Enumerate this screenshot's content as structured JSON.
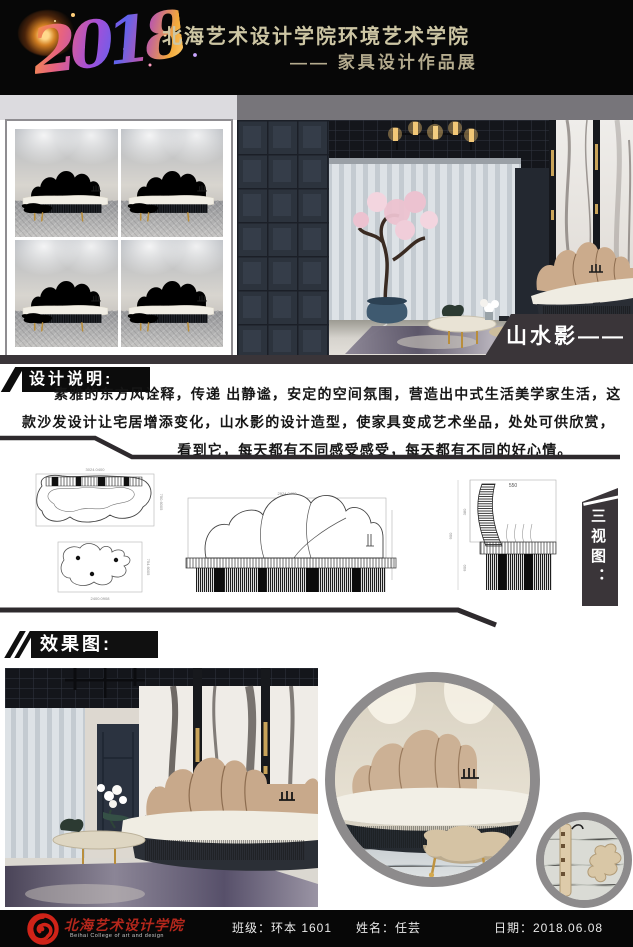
{
  "header": {
    "year": "2018",
    "school": "北海艺术设计学院环境艺术学院",
    "exhibition": "—— 家具设计作品展"
  },
  "top_section": {
    "project_label": "山水影——"
  },
  "design_notes": {
    "label": "设计说明:",
    "line1": "素雅的东方风诠释，传递 出静谧，安定的空间氛围，营造出中式生活美学家生活，这",
    "line2": "款沙发设计让宅居增添变化，山水影的设计造型，使家具变成艺术坐品，处处可供欣赏，",
    "line3": "看到它，每天都有不同感受感受，每天都有不同的好心情。"
  },
  "three_views": {
    "label": "三视图：",
    "dim_side_width": "550",
    "dim_side_back": "380",
    "dim_side_seat": "600",
    "dim_side_total": "900",
    "dim_front_width": "2924.0400",
    "dim_plan_width": "3024.0400",
    "dim_plan_depth": "750.6005",
    "dim_plan2_width": "2400.0908",
    "dim_plan2_depth": "754.6005"
  },
  "renders": {
    "label": "效果图:"
  },
  "footer": {
    "school_cn": "北海艺术设计学院",
    "school_en": "Beihai College of art and design",
    "class_field": "班级：环本 1601",
    "name_field": "姓名：任芸",
    "date_field": "日期：2018.06.08"
  },
  "colors": {
    "poster-black": "#070707",
    "label-bg": "#3a3539",
    "ink-line": "#2e2a2d",
    "band-light": "#dcdbdf",
    "band-dark": "#77757a",
    "header-gold": "#cdc6a4",
    "accent-red": "#b3271c",
    "sofa-tan": "#c5a284",
    "sofa-gray": "#565d67",
    "seat-cream": "#f1eee5"
  }
}
